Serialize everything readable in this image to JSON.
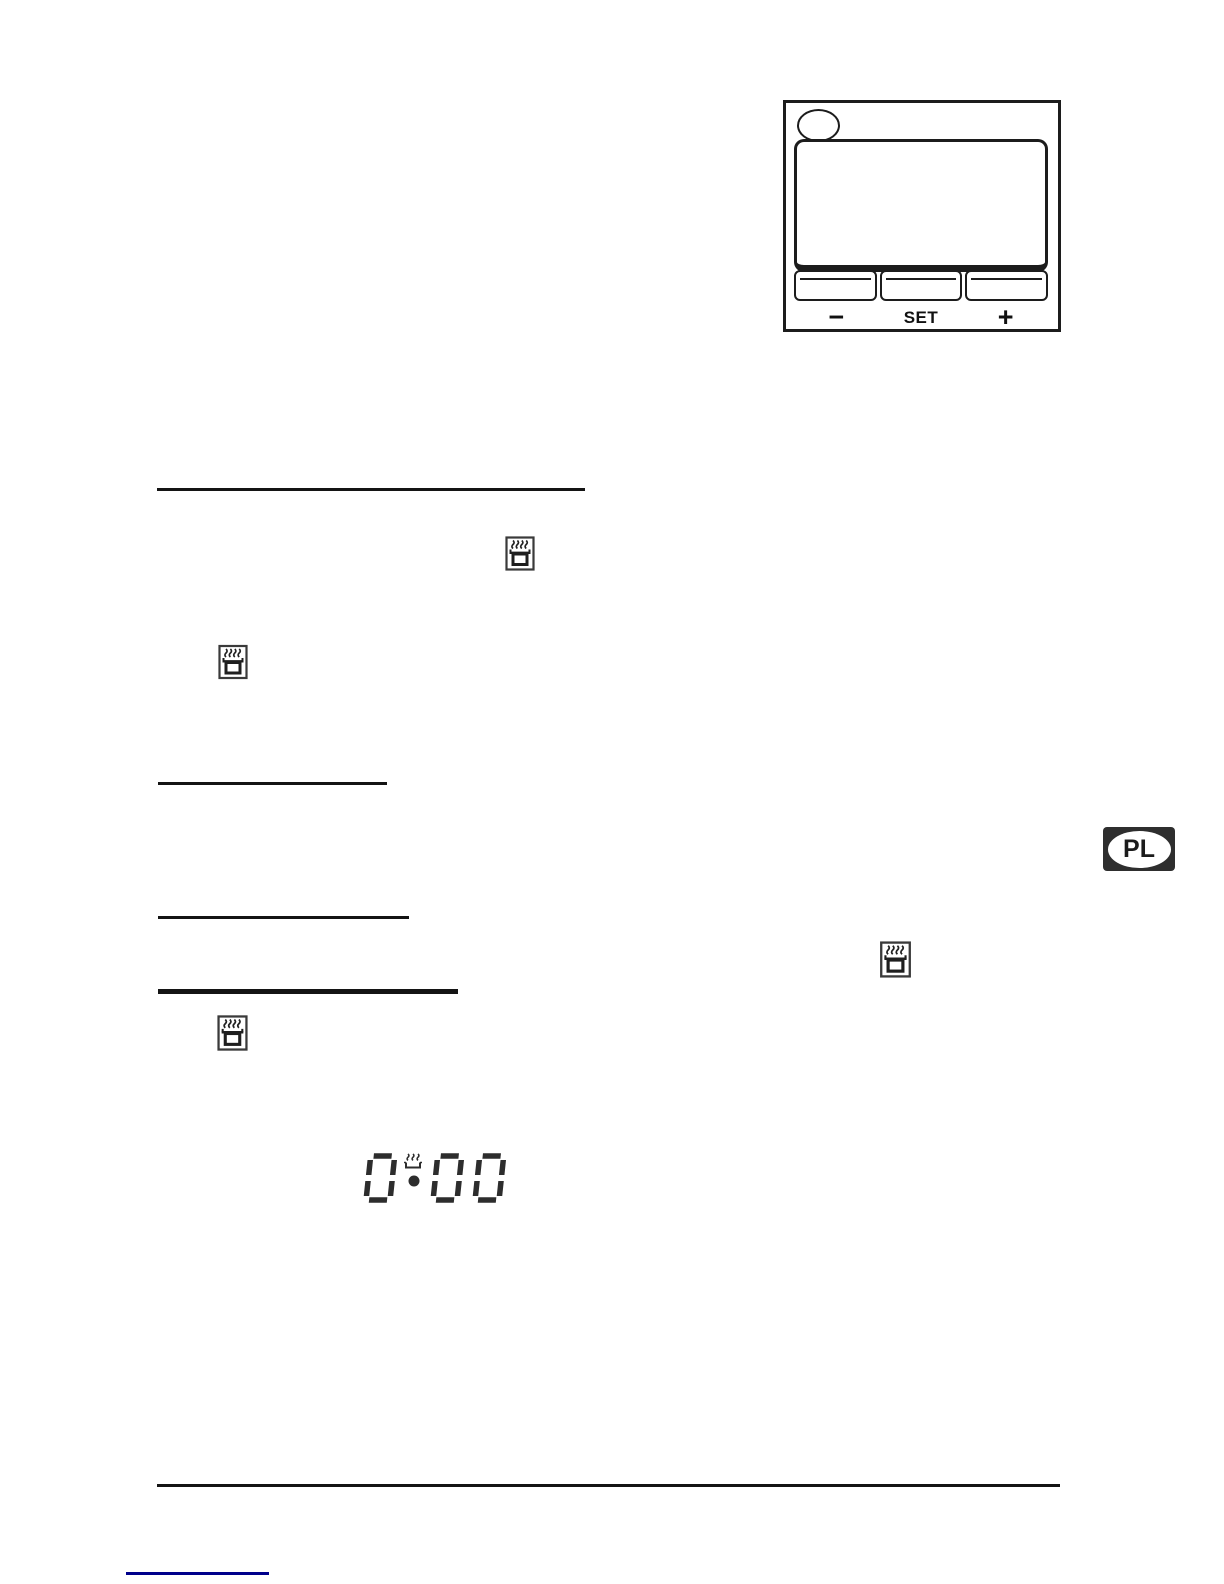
{
  "page": {
    "background": "#ffffff",
    "ink_color": "#1c1c1c",
    "link_color": "#00008b"
  },
  "control_panel_figure": {
    "indicator_lamp_icon": "oval-lamp-icon",
    "buttons": [
      {
        "id": "minus",
        "label": "−"
      },
      {
        "id": "set",
        "label": "SET"
      },
      {
        "id": "plus",
        "label": "+"
      }
    ]
  },
  "display_figure": {
    "value": "0:00",
    "indicator_icon": "steam-over-dish-icon"
  },
  "icons": {
    "hotplate_timer": "pot-with-steam-icon",
    "hotplate_timer_count": 4
  },
  "badges": {
    "country": "PL"
  }
}
